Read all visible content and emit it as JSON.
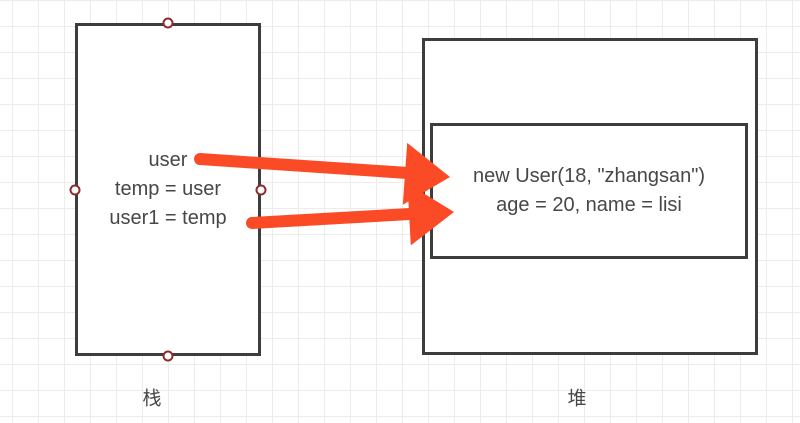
{
  "diagram": {
    "stack_box": {
      "lines": [
        "user",
        "temp = user",
        "user1 = temp"
      ],
      "label": "栈"
    },
    "heap_box": {
      "label": "堆",
      "object_box": {
        "lines": [
          "new User(18, \"zhangsan\")",
          "age = 20, name = lisi"
        ]
      }
    },
    "arrows": [
      {
        "name": "user-to-object",
        "from_text": "user",
        "to_text": "new User(18, \"zhangsan\")"
      },
      {
        "name": "user1-to-object",
        "from_text": "user1 = temp",
        "to_text": "age = 20, name = lisi"
      }
    ],
    "colors": {
      "arrow": "#fa4b26",
      "shape_border": "#3d3d3d",
      "text": "#474747",
      "handle_border": "#8f2b2b",
      "grid_line": "#ececec"
    }
  }
}
